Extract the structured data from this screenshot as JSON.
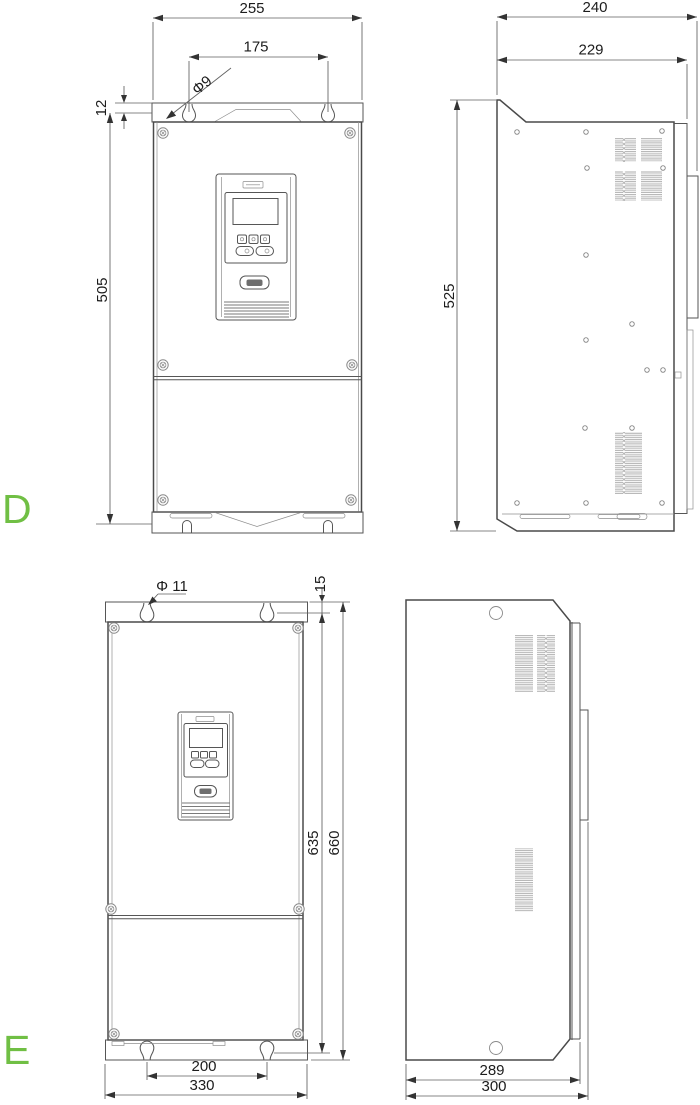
{
  "labels": {
    "section_d": "D",
    "section_e": "E"
  },
  "colors": {
    "label_green": "#70bf44",
    "line": "#4a4a4a"
  },
  "dimensions": {
    "d_front": {
      "total_width": "255",
      "hole_spacing": "175",
      "hole_diameter": "Φ9",
      "plate_offset": "12",
      "height": "505"
    },
    "d_side": {
      "total_depth": "240",
      "body_depth": "229",
      "height": "525"
    },
    "e_front": {
      "hole_diameter": "Φ 11",
      "plate_offset": "15",
      "height_to_holes": "635",
      "total_height": "660",
      "hole_spacing": "200",
      "total_width": "330"
    },
    "e_side": {
      "body_depth": "289",
      "total_depth": "300"
    }
  }
}
